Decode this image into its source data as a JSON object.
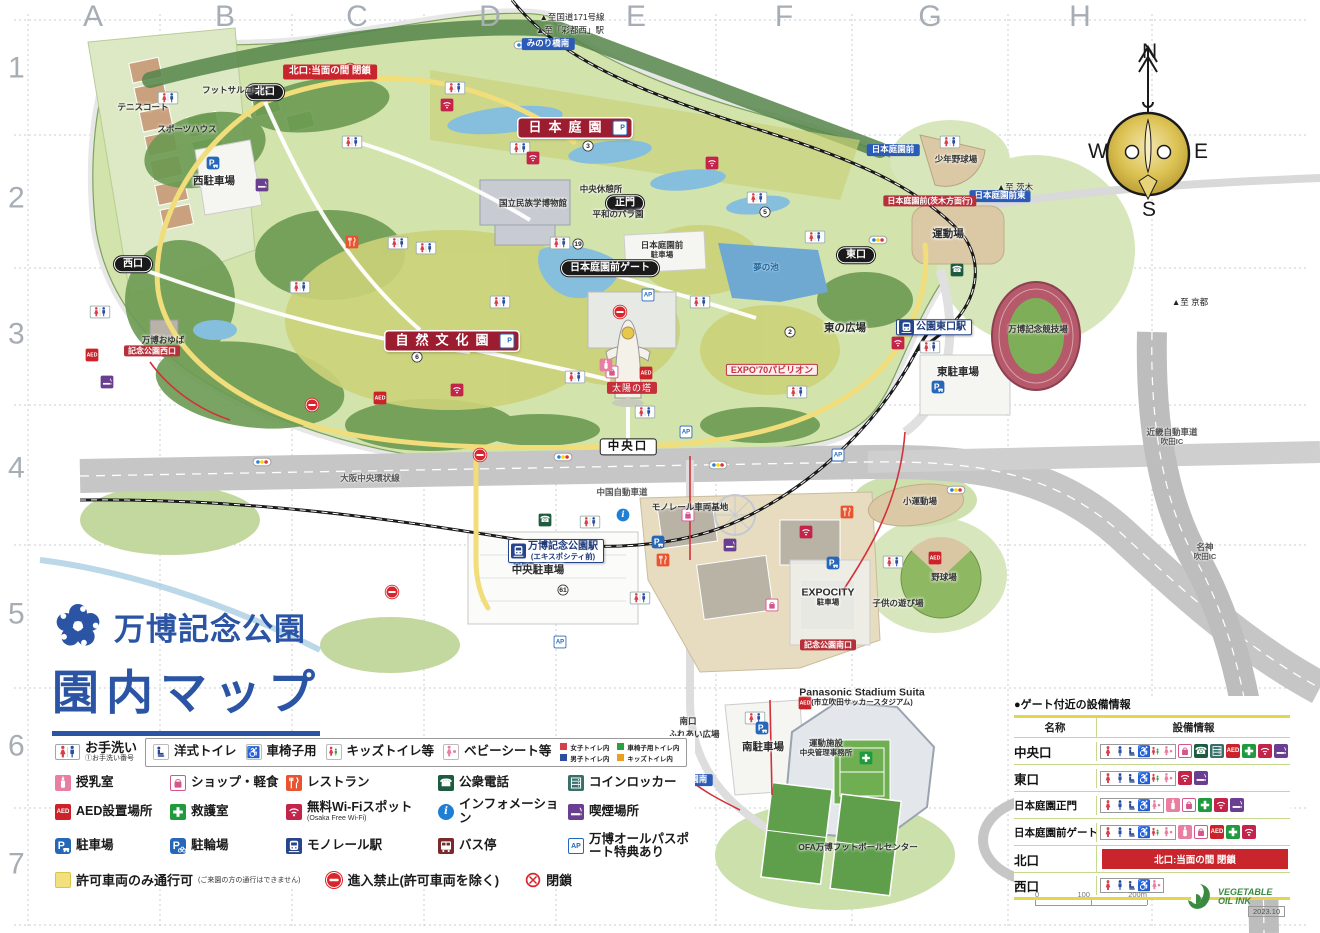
{
  "grid": {
    "columns": [
      "A",
      "B",
      "C",
      "D",
      "E",
      "F",
      "G",
      "H"
    ],
    "col_x": [
      93,
      225,
      357,
      490,
      636,
      784,
      930,
      1080
    ],
    "rows": [
      "1",
      "2",
      "3",
      "4",
      "5",
      "6",
      "7"
    ],
    "row_y": [
      70,
      200,
      336,
      470,
      616,
      748,
      866
    ]
  },
  "title": {
    "park_name": "万博記念公園",
    "map_title": "園内マップ"
  },
  "compass": {
    "n": "N",
    "e": "E",
    "s": "S",
    "w": "W"
  },
  "scale_bar": {
    "ticks": [
      "0",
      "100",
      "200m"
    ]
  },
  "footer": {
    "ink_logo_line1": "VEGETABLE",
    "ink_logo_line2": "OIL INK",
    "edition": "2023.10"
  },
  "colors": {
    "title_blue": "#2b55a4",
    "banner_red": "#9c1d30",
    "alert_red": "#c9252d",
    "route_yellow": "#f2df7d"
  },
  "legend": {
    "toilet_main": {
      "icon": "toilet",
      "label": "お手洗い",
      "sub": "①お手洗い番号"
    },
    "toilet_boxed": [
      {
        "icon": "western",
        "label": "洋式トイレ"
      },
      {
        "icon": "wheelchair",
        "label": "車椅子用"
      },
      {
        "icon": "kids",
        "label": "キッズトイレ等"
      },
      {
        "icon": "baby",
        "label": "ベビーシート等"
      }
    ],
    "color_key": [
      {
        "color": "#d6404a",
        "label": "女子トイレ内"
      },
      {
        "color": "#2f9e41",
        "label": "車椅子用トイレ内"
      },
      {
        "color": "#2b4f9e",
        "label": "男子トイレ内"
      },
      {
        "color": "#e8a01f",
        "label": "キッズトイレ内"
      }
    ],
    "rows": [
      [
        {
          "icon": "nursing",
          "label": "授乳室"
        },
        {
          "icon": "shop",
          "label": "ショップ・軽食"
        },
        {
          "icon": "restaurant",
          "label": "レストラン"
        },
        {
          "icon": "phone",
          "label": "公衆電話"
        },
        {
          "icon": "locker",
          "label": "コインロッカー"
        }
      ],
      [
        {
          "icon": "aed",
          "label": "AED設置場所"
        },
        {
          "icon": "firstaid",
          "label": "救護室"
        },
        {
          "icon": "wifi",
          "label": "無料Wi-Fiスポット",
          "sub": "(Osaka Free Wi-Fi)"
        },
        {
          "icon": "info",
          "label": "インフォメーション"
        },
        {
          "icon": "smoking",
          "label": "喫煙場所"
        }
      ],
      [
        {
          "icon": "parking",
          "label": "駐車場"
        },
        {
          "icon": "bikeparking",
          "label": "駐輪場"
        },
        {
          "icon": "monorail",
          "label": "モノレール駅"
        },
        {
          "icon": "bus",
          "label": "バス停"
        },
        {
          "icon": "ap",
          "label": "万博オールパスポート特典あり"
        }
      ]
    ],
    "route_row": [
      {
        "icon": "yellowroute",
        "label": "許可車両のみ通行可",
        "sub": "(ご来園の方の通行はできません)"
      },
      {
        "icon": "noentry",
        "label": "進入禁止(許可車両を除く)"
      },
      {
        "icon": "closed",
        "label": "閉鎖"
      }
    ]
  },
  "gate_info": {
    "title": "●ゲート付近の設備情報",
    "col_name": "名称",
    "col_facilities": "設備情報",
    "rows": [
      {
        "name": "中央口",
        "toilet": [
          "female",
          "male",
          "western",
          "wheelchair",
          "kids",
          "baby"
        ],
        "services": [
          "shop",
          "phone",
          "locker",
          "aed",
          "firstaid",
          "wifi",
          "smoking"
        ]
      },
      {
        "name": "東口",
        "toilet": [
          "female",
          "male",
          "western",
          "wheelchair",
          "kids",
          "baby"
        ],
        "services": [
          "wifi",
          "smoking"
        ]
      },
      {
        "name": "日本庭園正門",
        "toilet": [
          "female",
          "male",
          "western",
          "wheelchair",
          "baby"
        ],
        "services": [
          "nursing",
          "shop",
          "firstaid",
          "wifi",
          "smoking"
        ]
      },
      {
        "name": "日本庭園前ゲート",
        "toilet": [
          "female",
          "male",
          "western",
          "wheelchair",
          "kids",
          "baby"
        ],
        "services": [
          "nursing",
          "shop",
          "aed",
          "firstaid",
          "wifi"
        ]
      },
      {
        "name": "北口",
        "closed": "北口:当面の間 閉鎖"
      },
      {
        "name": "西口",
        "toilet": [
          "female",
          "male",
          "western",
          "wheelchair",
          "baby"
        ],
        "services": []
      }
    ]
  },
  "map": {
    "labels": [
      {
        "name": "label-japanese-garden",
        "text": "日本庭園",
        "x": 575,
        "y": 128,
        "type": "banner",
        "ap": true
      },
      {
        "name": "label-natural-culture-garden",
        "text": "自然文化園",
        "x": 452,
        "y": 341,
        "type": "banner",
        "ap": true
      },
      {
        "name": "label-tower-of-the-sun",
        "text": "太陽の塔",
        "x": 632,
        "y": 388,
        "type": "poi-red"
      },
      {
        "name": "label-expo70-pavilion",
        "text": "EXPO'70パビリオン",
        "x": 772,
        "y": 370,
        "type": "poi-redline"
      },
      {
        "name": "label-central-gate",
        "text": "中央口",
        "x": 628,
        "y": 447,
        "type": "gate-white"
      },
      {
        "name": "label-main-gate",
        "text": "正門",
        "x": 625,
        "y": 203,
        "type": "gate-black"
      },
      {
        "name": "label-garden-front-gate",
        "text": "日本庭園前ゲート",
        "x": 610,
        "y": 268,
        "type": "gate-black"
      },
      {
        "name": "label-north-gate",
        "text": "北口",
        "x": 265,
        "y": 92,
        "type": "gate-black"
      },
      {
        "name": "label-west-gate",
        "text": "西口",
        "x": 133,
        "y": 264,
        "type": "gate-black"
      },
      {
        "name": "label-east-gate",
        "text": "東口",
        "x": 856,
        "y": 255,
        "type": "gate-black"
      },
      {
        "name": "label-south-gate",
        "text": "南口",
        "x": 688,
        "y": 722,
        "type": "plain-sm"
      },
      {
        "name": "label-north-gate-closed",
        "text": "北口:当面の間 閉鎖",
        "x": 330,
        "y": 72,
        "type": "alert"
      },
      {
        "name": "label-banpaku-kinen-koen-station",
        "text": "万博記念公園駅",
        "sub": "(エキスポシティ前)",
        "x": 556,
        "y": 551,
        "type": "station",
        "icon": "monorail"
      },
      {
        "name": "label-koen-higashiguchi-station",
        "text": "公園東口駅",
        "x": 934,
        "y": 327,
        "type": "station",
        "icon": "monorail"
      },
      {
        "name": "label-bus-minoribashi-minami",
        "text": "みのり橋南",
        "x": 548,
        "y": 44,
        "type": "bus-blue"
      },
      {
        "name": "label-bus-nihonteien-mae-higashi",
        "text": "日本庭園前東",
        "x": 1000,
        "y": 196,
        "type": "bus-blue"
      },
      {
        "name": "label-bus-nihonteien-mae",
        "text": "日本庭園前",
        "x": 893,
        "y": 150,
        "type": "bus-blue"
      },
      {
        "name": "label-bus-nihonteien-mae-ibaraki",
        "text": "日本庭園前(茨木方面行)",
        "x": 930,
        "y": 201,
        "type": "bus-red"
      },
      {
        "name": "label-bus-kinen-koen-nishiguchi",
        "text": "記念公園西口",
        "x": 152,
        "y": 351,
        "type": "bus-red"
      },
      {
        "name": "label-bus-kinen-koen-minamiguchi",
        "text": "記念公園南口",
        "x": 828,
        "y": 645,
        "type": "bus-red"
      },
      {
        "name": "label-bus-banpaku-koen-minami",
        "text": "万博公園南",
        "x": 686,
        "y": 780,
        "type": "bus-blue"
      },
      {
        "name": "label-east-parking",
        "text": "東駐車場",
        "x": 958,
        "y": 372,
        "type": "plain"
      },
      {
        "name": "label-south-parking",
        "text": "南駐車場",
        "x": 763,
        "y": 747,
        "type": "plain"
      },
      {
        "name": "label-central-parking",
        "text": "中央駐車場",
        "x": 538,
        "y": 570,
        "type": "plain"
      },
      {
        "name": "label-west-parking",
        "text": "西駐車場",
        "x": 214,
        "y": 181,
        "type": "plain"
      },
      {
        "name": "label-expocity-parking",
        "text": "EXPOCITY",
        "sub": "駐車場",
        "x": 828,
        "y": 597,
        "type": "plain"
      },
      {
        "name": "label-garden-front-parking",
        "text": "日本庭園前",
        "sub": "駐車場",
        "x": 662,
        "y": 250,
        "type": "plain-sm"
      },
      {
        "name": "label-athletic-field",
        "text": "運動場",
        "x": 948,
        "y": 234,
        "type": "plain"
      },
      {
        "name": "label-youth-baseball-field",
        "text": "少年野球場",
        "x": 956,
        "y": 160,
        "type": "plain-sm"
      },
      {
        "name": "label-small-athletic-field",
        "text": "小運動場",
        "x": 920,
        "y": 502,
        "type": "plain-sm"
      },
      {
        "name": "label-baseball-field",
        "text": "野球場",
        "x": 944,
        "y": 578,
        "type": "plain-sm"
      },
      {
        "name": "label-expo-stadium",
        "text": "万博記念競技場",
        "x": 1038,
        "y": 330,
        "type": "plain-sm"
      },
      {
        "name": "label-higashi-no-hiroba",
        "text": "東の広場",
        "x": 845,
        "y": 328,
        "type": "plain"
      },
      {
        "name": "label-kodomo-no-asobiba",
        "text": "子供の遊び場",
        "x": 898,
        "y": 604,
        "type": "plain-sm"
      },
      {
        "name": "label-fureai-hiroba",
        "text": "ふれあい広場",
        "x": 694,
        "y": 735,
        "type": "plain-sm"
      },
      {
        "name": "label-panasonic-stadium",
        "text": "Panasonic Stadium Suita",
        "sub": "(市立吹田サッカースタジアム)",
        "x": 862,
        "y": 697,
        "type": "plain"
      },
      {
        "name": "label-sports-admin-office",
        "text": "運動施設",
        "sub": "中央管理事務所",
        "x": 826,
        "y": 748,
        "type": "plain-sm"
      },
      {
        "name": "label-ethnology-museum",
        "text": "国立民族学博物館",
        "x": 533,
        "y": 204,
        "type": "plain-sm"
      },
      {
        "name": "label-central-rest-area",
        "text": "中央休憩所",
        "x": 601,
        "y": 190,
        "type": "plain-sm"
      },
      {
        "name": "label-peace-rose-garden",
        "text": "平和のバラ園",
        "x": 618,
        "y": 215,
        "type": "plain-sm"
      },
      {
        "name": "label-tennis-courts",
        "text": "テニスコート",
        "x": 143,
        "y": 108,
        "type": "plain-sm"
      },
      {
        "name": "label-futsal-courts",
        "text": "フットサルコート",
        "x": 236,
        "y": 91,
        "type": "plain-sm"
      },
      {
        "name": "label-sports-house",
        "text": "スポーツハウス",
        "x": 187,
        "y": 130,
        "type": "plain-sm"
      },
      {
        "name": "label-banpaku-oyuba",
        "text": "万博おゆば",
        "x": 163,
        "y": 341,
        "type": "plain-sm"
      },
      {
        "name": "label-ofa-football-center",
        "text": "OFA万博フットボールセンター",
        "x": 858,
        "y": 848,
        "type": "plain-sm"
      },
      {
        "name": "label-monorail-depot",
        "text": "モノレール車両基地",
        "x": 690,
        "y": 508,
        "type": "plain-sm"
      },
      {
        "name": "label-yume-no-ike",
        "text": "夢の池",
        "x": 766,
        "y": 268,
        "type": "water"
      },
      {
        "name": "label-osaka-chuo-kanjo",
        "text": "大阪中央環状線",
        "x": 370,
        "y": 479,
        "type": "road"
      },
      {
        "name": "label-chugoku-expressway",
        "text": "中国自動車道",
        "x": 622,
        "y": 493,
        "type": "road"
      },
      {
        "name": "label-kinki-expressway",
        "text": "近畿自動車道",
        "sub": "吹田IC",
        "x": 1172,
        "y": 437,
        "type": "road"
      },
      {
        "name": "label-meishin-suita-ic",
        "text": "名神",
        "sub": "吹田IC",
        "x": 1205,
        "y": 552,
        "type": "road"
      },
      {
        "name": "label-to-route171",
        "text": "▲至国道171号線",
        "x": 572,
        "y": 18,
        "type": "dir"
      },
      {
        "name": "label-to-saito-nishi",
        "text": "▲至「彩都西」駅",
        "x": 570,
        "y": 31,
        "type": "dir"
      },
      {
        "name": "label-to-ibaraki",
        "text": "▲至 茨木",
        "x": 1015,
        "y": 188,
        "type": "dir"
      },
      {
        "name": "label-to-kyoto",
        "text": "▲至 京都",
        "x": 1190,
        "y": 303,
        "type": "dir"
      }
    ],
    "icons": [
      {
        "t": "toilet",
        "x": 352,
        "y": 142
      },
      {
        "t": "toilet",
        "x": 300,
        "y": 287
      },
      {
        "t": "toilet",
        "x": 398,
        "y": 243
      },
      {
        "t": "toilet",
        "x": 455,
        "y": 88
      },
      {
        "t": "toilet",
        "x": 520,
        "y": 148
      },
      {
        "t": "toilet",
        "x": 560,
        "y": 243
      },
      {
        "t": "toilet",
        "x": 500,
        "y": 302
      },
      {
        "t": "toilet",
        "x": 575,
        "y": 377
      },
      {
        "t": "toilet",
        "x": 645,
        "y": 412
      },
      {
        "t": "toilet",
        "x": 700,
        "y": 302
      },
      {
        "t": "toilet",
        "x": 757,
        "y": 198
      },
      {
        "t": "toilet",
        "x": 797,
        "y": 392
      },
      {
        "t": "toilet",
        "x": 930,
        "y": 347
      },
      {
        "t": "toilet",
        "x": 100,
        "y": 312
      },
      {
        "t": "toilet",
        "x": 168,
        "y": 98
      },
      {
        "t": "toilet",
        "x": 590,
        "y": 522
      },
      {
        "t": "toilet",
        "x": 755,
        "y": 718
      },
      {
        "t": "toilet",
        "x": 893,
        "y": 562
      },
      {
        "t": "toilet",
        "x": 950,
        "y": 142
      },
      {
        "t": "toilet",
        "x": 640,
        "y": 598
      },
      {
        "t": "toilet",
        "x": 426,
        "y": 248
      },
      {
        "t": "toilet",
        "x": 815,
        "y": 237
      },
      {
        "t": "wifi",
        "x": 447,
        "y": 105
      },
      {
        "t": "wifi",
        "x": 533,
        "y": 158
      },
      {
        "t": "wifi",
        "x": 712,
        "y": 163
      },
      {
        "t": "wifi",
        "x": 457,
        "y": 390
      },
      {
        "t": "wifi",
        "x": 806,
        "y": 532
      },
      {
        "t": "wifi",
        "x": 898,
        "y": 343
      },
      {
        "t": "aed",
        "x": 92,
        "y": 355
      },
      {
        "t": "aed",
        "x": 646,
        "y": 373
      },
      {
        "t": "aed",
        "x": 380,
        "y": 398
      },
      {
        "t": "aed",
        "x": 935,
        "y": 558
      },
      {
        "t": "aed",
        "x": 805,
        "y": 703
      },
      {
        "t": "parking",
        "x": 213,
        "y": 163
      },
      {
        "t": "parking",
        "x": 520,
        "y": 560
      },
      {
        "t": "parking",
        "x": 658,
        "y": 542
      },
      {
        "t": "parking",
        "x": 762,
        "y": 728
      },
      {
        "t": "parking",
        "x": 938,
        "y": 387
      },
      {
        "t": "parking",
        "x": 833,
        "y": 563
      },
      {
        "t": "parking",
        "x": 688,
        "y": 812
      },
      {
        "t": "ap",
        "x": 648,
        "y": 295
      },
      {
        "t": "ap",
        "x": 686,
        "y": 432
      },
      {
        "t": "ap",
        "x": 838,
        "y": 455
      },
      {
        "t": "ap",
        "x": 560,
        "y": 642
      },
      {
        "t": "signal",
        "x": 523,
        "y": 45
      },
      {
        "t": "signal",
        "x": 878,
        "y": 240
      },
      {
        "t": "signal",
        "x": 563,
        "y": 457
      },
      {
        "t": "signal",
        "x": 718,
        "y": 465
      },
      {
        "t": "signal",
        "x": 956,
        "y": 490
      },
      {
        "t": "signal",
        "x": 680,
        "y": 772
      },
      {
        "t": "signal",
        "x": 262,
        "y": 462
      },
      {
        "t": "noentry",
        "x": 350,
        "y": 70
      },
      {
        "t": "noentry",
        "x": 312,
        "y": 405
      },
      {
        "t": "noentry",
        "x": 480,
        "y": 455
      },
      {
        "t": "noentry",
        "x": 620,
        "y": 312
      },
      {
        "t": "noentry",
        "x": 392,
        "y": 592
      },
      {
        "t": "smoking",
        "x": 262,
        "y": 185
      },
      {
        "t": "smoking",
        "x": 107,
        "y": 382
      },
      {
        "t": "smoking",
        "x": 730,
        "y": 545
      },
      {
        "t": "restaurant",
        "x": 352,
        "y": 242
      },
      {
        "t": "restaurant",
        "x": 847,
        "y": 512
      },
      {
        "t": "restaurant",
        "x": 663,
        "y": 560
      },
      {
        "t": "shop",
        "x": 612,
        "y": 372
      },
      {
        "t": "shop",
        "x": 688,
        "y": 515
      },
      {
        "t": "shop",
        "x": 772,
        "y": 605
      },
      {
        "t": "phone",
        "x": 957,
        "y": 270
      },
      {
        "t": "phone",
        "x": 545,
        "y": 520
      },
      {
        "t": "locker",
        "x": 528,
        "y": 558
      },
      {
        "t": "info",
        "x": 623,
        "y": 515
      },
      {
        "t": "firstaid",
        "x": 866,
        "y": 758
      },
      {
        "t": "nursing",
        "x": 606,
        "y": 365
      }
    ],
    "numbers": [
      {
        "n": "2",
        "x": 790,
        "y": 332
      },
      {
        "n": "3",
        "x": 588,
        "y": 146
      },
      {
        "n": "5",
        "x": 765,
        "y": 212
      },
      {
        "n": "6",
        "x": 417,
        "y": 357
      },
      {
        "n": "19",
        "x": 578,
        "y": 244
      },
      {
        "n": "61",
        "x": 563,
        "y": 590
      }
    ]
  }
}
